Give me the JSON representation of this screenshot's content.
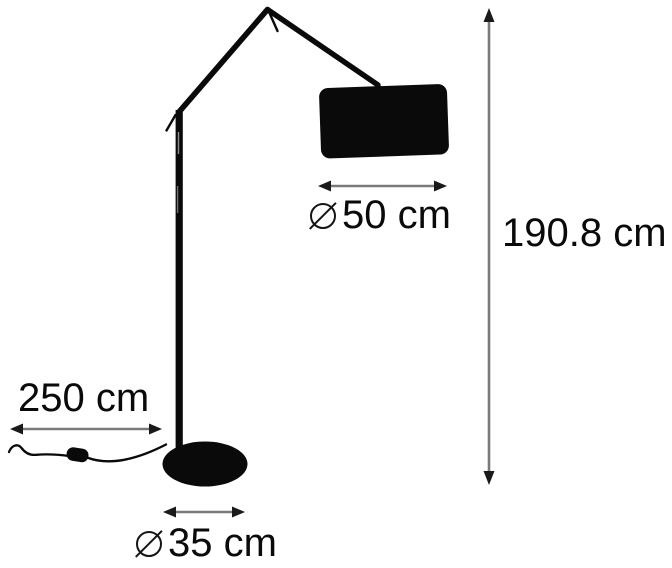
{
  "diagram": {
    "kind": "product-dimension-diagram",
    "subject": "articulated floor lamp with cylindrical shade and round base",
    "background_color": "#ffffff",
    "colors": {
      "drawing_ink": "#0a0a0a",
      "dimension_line": "#7a7a7a",
      "arrowhead": "#1a1a1a",
      "text": "#0a0a0a"
    },
    "measurements": {
      "shade_diameter": {
        "symbol": "⌀",
        "value": "50 cm",
        "orientation": "horizontal"
      },
      "total_height": {
        "value": "190.8 cm",
        "orientation": "vertical"
      },
      "cord_length": {
        "value": "250 cm",
        "orientation": "horizontal"
      },
      "base_diameter": {
        "symbol": "⌀",
        "value": "35 cm",
        "orientation": "horizontal"
      }
    }
  }
}
